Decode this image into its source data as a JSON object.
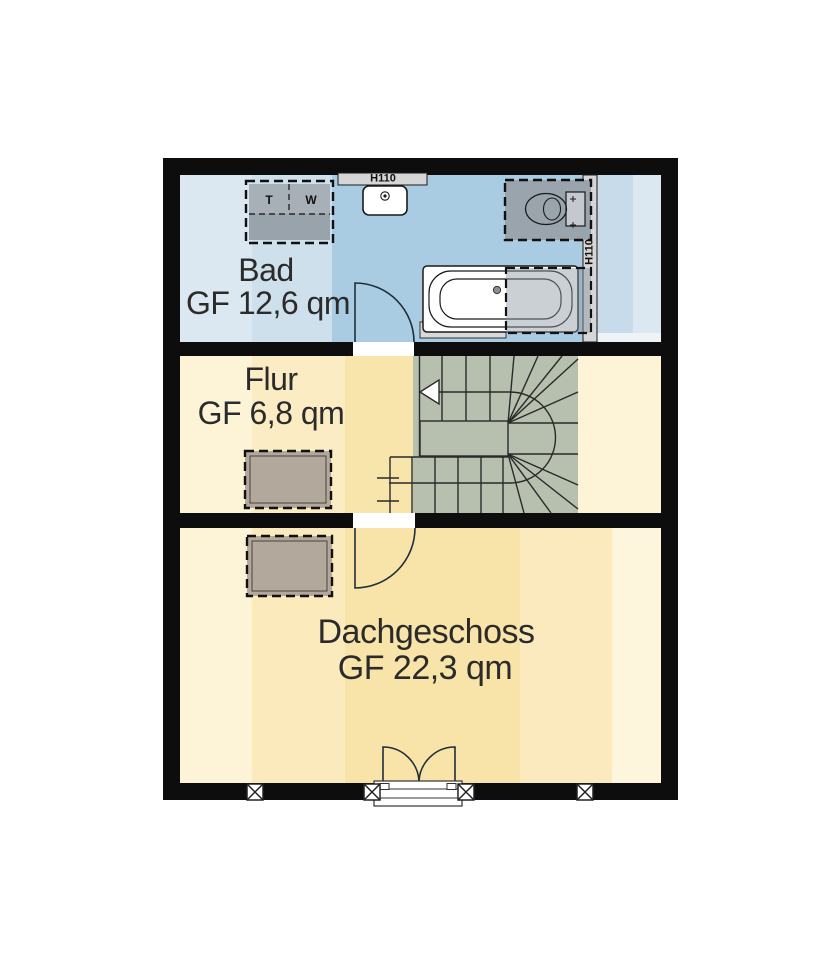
{
  "plan": {
    "rooms": [
      {
        "name": "Bad",
        "area": "GF 12,6 qm"
      },
      {
        "name": "Flur",
        "area": "GF 6,8 qm"
      },
      {
        "name": "Dachgeschoss",
        "area": "GF 22,3 qm"
      }
    ],
    "annotations": {
      "knee_wall_top": "H110",
      "knee_wall_right": "H110",
      "dryer_label": "T",
      "washer_label": "W"
    },
    "colors": {
      "wall": "#0d0d0d",
      "bad_floor": "#aacce3",
      "flur_floor": "#f8e5ac",
      "dachgeschoss_floor": "#f8e3a8",
      "stair": "#b7bfae",
      "furniture": "#b2a89b",
      "appliance": "#9aa3ab",
      "knee_wall": "#d6d6d6",
      "text": "#2b2b2b"
    }
  }
}
